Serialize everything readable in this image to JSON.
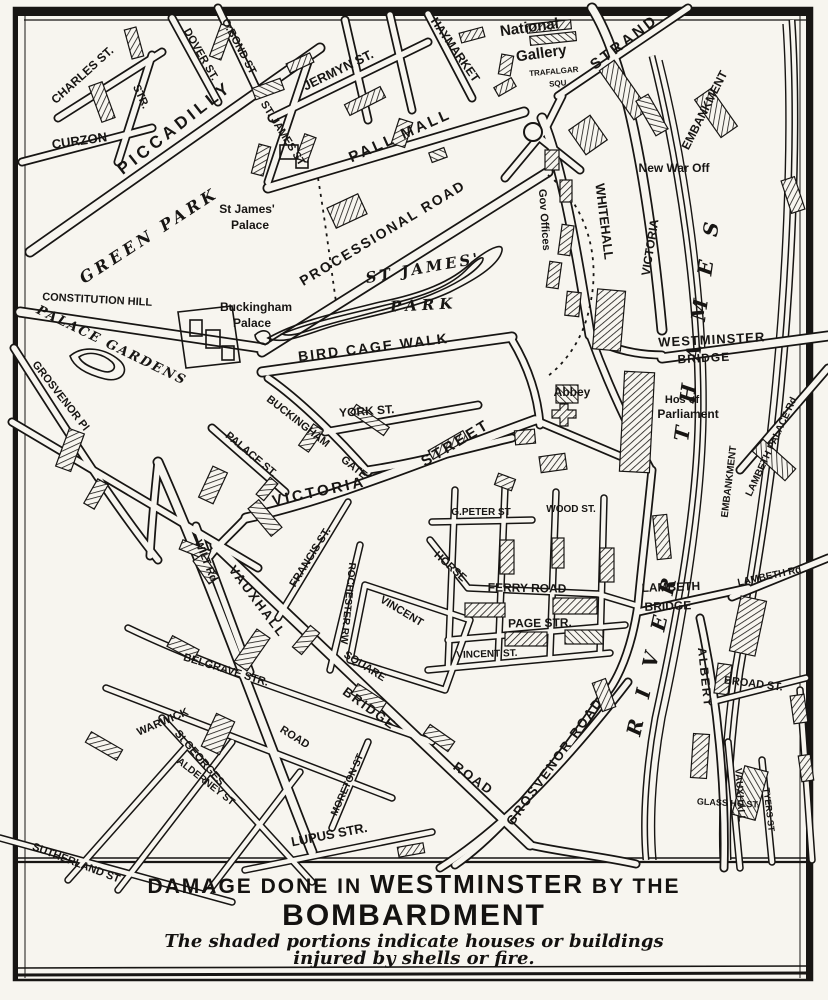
{
  "caption": {
    "line1_pre": "DAMAGE DONE IN ",
    "line1_em": "WESTMINSTER",
    "line1_post": " BY THE",
    "line2": "BOMBARDMENT",
    "note_line1": "The shaded portions indicate houses or buildings",
    "note_line2": "injured by shells or fire."
  },
  "colors": {
    "ink": "#171513",
    "paper": "#f7f5ef"
  },
  "map": {
    "labels": [
      {
        "text": "CHARLES ST.",
        "x": 85,
        "y": 78,
        "r": -42,
        "fs": 12
      },
      {
        "text": "STR.",
        "x": 138,
        "y": 98,
        "r": 65,
        "fs": 11
      },
      {
        "text": "DOVER ST.",
        "x": 198,
        "y": 56,
        "r": 60,
        "fs": 11
      },
      {
        "text": "O.BOND ST",
        "x": 236,
        "y": 48,
        "r": 62,
        "fs": 11
      },
      {
        "text": "CURZON",
        "x": 80,
        "y": 145,
        "r": -8,
        "fs": 13
      },
      {
        "text": "PICCADILLY",
        "x": 178,
        "y": 132,
        "r": -38,
        "fs": 17,
        "ls": 4
      },
      {
        "text": "JERMYN ST.",
        "x": 340,
        "y": 74,
        "r": -26,
        "fs": 13
      },
      {
        "text": "ST. JAMES ST",
        "x": 280,
        "y": 135,
        "r": 58,
        "fs": 11
      },
      {
        "text": "HAYMARKET",
        "x": 452,
        "y": 52,
        "r": 55,
        "fs": 12
      },
      {
        "text": "PALL MALL",
        "x": 402,
        "y": 140,
        "r": -24,
        "fs": 15,
        "ls": 3
      },
      {
        "text": "National",
        "x": 530,
        "y": 32,
        "r": -8,
        "fs": 15
      },
      {
        "text": "Gallery",
        "x": 542,
        "y": 58,
        "r": -8,
        "fs": 15
      },
      {
        "text": "TRAFALGAR",
        "x": 554,
        "y": 74,
        "r": -5,
        "fs": 8
      },
      {
        "text": "SQU",
        "x": 558,
        "y": 86,
        "r": -5,
        "fs": 8
      },
      {
        "text": "STRAND",
        "x": 627,
        "y": 46,
        "r": -37,
        "fs": 15,
        "ls": 3
      },
      {
        "text": "EMBANKMENT",
        "x": 708,
        "y": 112,
        "r": -63,
        "fs": 12
      },
      {
        "text": "VICTORIA",
        "x": 654,
        "y": 248,
        "r": -81,
        "fs": 12
      },
      {
        "text": "New War Off",
        "x": 674,
        "y": 172,
        "r": 0,
        "fs": 12
      },
      {
        "text": "WHITEHALL",
        "x": 600,
        "y": 222,
        "r": 83,
        "fs": 13
      },
      {
        "text": "Gov Offices",
        "x": 541,
        "y": 220,
        "r": 86,
        "fs": 11
      },
      {
        "text": "St James'",
        "x": 247,
        "y": 213,
        "r": 0,
        "fs": 12
      },
      {
        "text": "Palace",
        "x": 250,
        "y": 229,
        "r": 0,
        "fs": 12
      },
      {
        "text": "GREEN PARK",
        "x": 152,
        "y": 240,
        "r": -33,
        "fs": 16,
        "ls": 4,
        "i": 1
      },
      {
        "text": "CONSTITUTION HILL",
        "x": 97,
        "y": 303,
        "r": 3,
        "fs": 11
      },
      {
        "text": "PALACE GARDENS",
        "x": 110,
        "y": 349,
        "r": 26,
        "fs": 13,
        "ls": 2,
        "i": 1
      },
      {
        "text": "GROSVENOR Pl",
        "x": 58,
        "y": 398,
        "r": 52,
        "fs": 11
      },
      {
        "text": "Buckingham",
        "x": 256,
        "y": 311,
        "r": 0,
        "fs": 12
      },
      {
        "text": "Palace",
        "x": 252,
        "y": 327,
        "r": 0,
        "fs": 12
      },
      {
        "text": "PROCESSIONAL ROAD",
        "x": 385,
        "y": 237,
        "r": -31,
        "fs": 14,
        "ls": 2
      },
      {
        "text": "ST JAMES'",
        "x": 424,
        "y": 273,
        "r": -10,
        "fs": 15,
        "ls": 3,
        "i": 1
      },
      {
        "text": "PARK",
        "x": 424,
        "y": 310,
        "r": -3,
        "fs": 15,
        "ls": 5,
        "i": 1
      },
      {
        "text": "BIRD CAGE WALK",
        "x": 374,
        "y": 352,
        "r": -7,
        "fs": 14,
        "ls": 2
      },
      {
        "text": "WESTMINSTER",
        "x": 712,
        "y": 344,
        "r": -3,
        "fs": 13,
        "ls": 1
      },
      {
        "text": "BRIDGE",
        "x": 704,
        "y": 362,
        "r": -3,
        "fs": 12,
        "ls": 1
      },
      {
        "text": "Abbey",
        "x": 572,
        "y": 396,
        "r": 0,
        "fs": 12
      },
      {
        "text": "Hos of",
        "x": 682,
        "y": 403,
        "r": 0,
        "fs": 11
      },
      {
        "text": "Parliament",
        "x": 688,
        "y": 418,
        "r": 0,
        "fs": 12
      },
      {
        "text": "YORK ST.",
        "x": 367,
        "y": 415,
        "r": -4,
        "fs": 12
      },
      {
        "text": "BUCKINGHAM",
        "x": 296,
        "y": 424,
        "r": 38,
        "fs": 11
      },
      {
        "text": "GATE",
        "x": 352,
        "y": 470,
        "r": 38,
        "fs": 11
      },
      {
        "text": "PALACE ST.",
        "x": 249,
        "y": 457,
        "r": 40,
        "fs": 11
      },
      {
        "text": "VICTORIA",
        "x": 320,
        "y": 496,
        "r": -12,
        "fs": 15,
        "ls": 3
      },
      {
        "text": "STREET",
        "x": 458,
        "y": 447,
        "r": -31,
        "fs": 15,
        "ls": 3
      },
      {
        "text": "G.PETER ST",
        "x": 481,
        "y": 515,
        "r": 0,
        "fs": 10
      },
      {
        "text": "WOOD ST.",
        "x": 571,
        "y": 512,
        "r": 0,
        "fs": 10
      },
      {
        "text": "HORSE",
        "x": 448,
        "y": 569,
        "r": 42,
        "fs": 11
      },
      {
        "text": "FERRY ROAD",
        "x": 527,
        "y": 592,
        "r": 1,
        "fs": 12
      },
      {
        "text": "PAGE STR.",
        "x": 540,
        "y": 627,
        "r": -1,
        "fs": 12
      },
      {
        "text": "VINCENT ST.",
        "x": 487,
        "y": 657,
        "r": -2,
        "fs": 10
      },
      {
        "text": "VINCENT",
        "x": 400,
        "y": 614,
        "r": 31,
        "fs": 11
      },
      {
        "text": "SQUARE",
        "x": 363,
        "y": 669,
        "r": 32,
        "fs": 11
      },
      {
        "text": "ROCHESTER RW",
        "x": 345,
        "y": 603,
        "r": 96,
        "fs": 10
      },
      {
        "text": "FRANCIS ST.",
        "x": 313,
        "y": 559,
        "r": -58,
        "fs": 11
      },
      {
        "text": "WILT Rd",
        "x": 203,
        "y": 562,
        "r": 68,
        "fs": 11
      },
      {
        "text": "VAUXHALL",
        "x": 254,
        "y": 604,
        "r": 53,
        "fs": 13,
        "ls": 2
      },
      {
        "text": "BRIDGE",
        "x": 367,
        "y": 712,
        "r": 36,
        "fs": 13,
        "ls": 2
      },
      {
        "text": "ROAD",
        "x": 471,
        "y": 782,
        "r": 36,
        "fs": 13,
        "ls": 2
      },
      {
        "text": "BELGRAVE STR.",
        "x": 225,
        "y": 673,
        "r": 17,
        "fs": 11
      },
      {
        "text": "WARWICK",
        "x": 164,
        "y": 725,
        "r": -23,
        "fs": 11
      },
      {
        "text": "ROAD",
        "x": 293,
        "y": 740,
        "r": 32,
        "fs": 11
      },
      {
        "text": "St GEORGES",
        "x": 197,
        "y": 760,
        "r": 49,
        "fs": 11
      },
      {
        "text": "ALDERNEY ST",
        "x": 204,
        "y": 784,
        "r": 38,
        "fs": 10
      },
      {
        "text": "SUTHERLAND ST",
        "x": 75,
        "y": 866,
        "r": 21,
        "fs": 11
      },
      {
        "text": "LUPUS STR.",
        "x": 330,
        "y": 839,
        "r": -11,
        "fs": 13
      },
      {
        "text": "MORETON ST",
        "x": 350,
        "y": 786,
        "r": -66,
        "fs": 10
      },
      {
        "text": "GROSVENOR ROAD",
        "x": 558,
        "y": 764,
        "r": -54,
        "fs": 13,
        "ls": 2
      },
      {
        "text": "LAMBETH",
        "x": 671,
        "y": 591,
        "r": -2,
        "fs": 12
      },
      {
        "text": "BRIDGE",
        "x": 668,
        "y": 610,
        "r": -2,
        "fs": 12
      },
      {
        "text": "LAMBETH Rd",
        "x": 770,
        "y": 579,
        "r": -12,
        "fs": 10
      },
      {
        "text": "LAMBETH PALACE Rd",
        "x": 774,
        "y": 448,
        "r": -65,
        "fs": 10
      },
      {
        "text": "EMBANKMENT",
        "x": 732,
        "y": 482,
        "r": -83,
        "fs": 10
      },
      {
        "text": "ALBERT",
        "x": 701,
        "y": 678,
        "r": 84,
        "fs": 12,
        "ls": 2
      },
      {
        "text": "BROAD ST.",
        "x": 753,
        "y": 687,
        "r": 7,
        "fs": 11
      },
      {
        "text": "VAUXHALL",
        "x": 737,
        "y": 795,
        "r": 86,
        "fs": 10
      },
      {
        "text": "GLASS HO.ST.",
        "x": 728,
        "y": 806,
        "r": 3,
        "fs": 9
      },
      {
        "text": "TYERS ST",
        "x": 766,
        "y": 810,
        "r": 83,
        "fs": 9
      },
      {
        "text": "RIVER",
        "x": 640,
        "y": 737,
        "r": -77,
        "fs": 20,
        "ls": 22,
        "a": "start",
        "i": 1
      },
      {
        "text": "THAMES",
        "x": 688,
        "y": 442,
        "r": -82,
        "fs": 20,
        "ls": 24,
        "a": "start",
        "i": 1
      }
    ]
  }
}
